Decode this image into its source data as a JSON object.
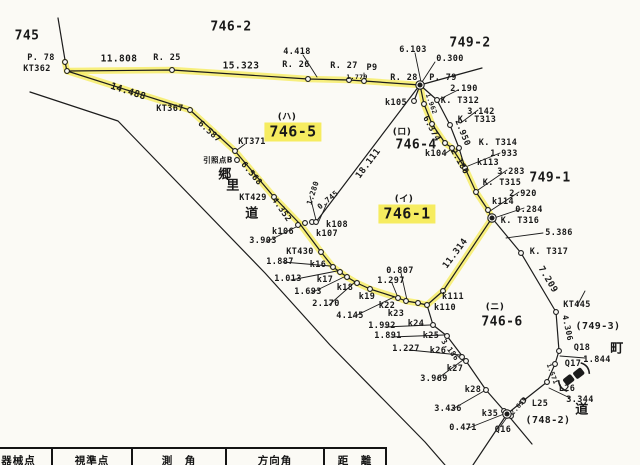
{
  "map": {
    "highlight_color": "#f6ec60",
    "ink_color": "#1c1c1c",
    "paper_color": "#fbfaf5",
    "highlighted_parcels": [
      "746-5",
      "746-1"
    ],
    "labels": [
      {
        "t": "745",
        "x": 27,
        "y": 36,
        "s": 13
      },
      {
        "t": "746-2",
        "x": 231,
        "y": 27,
        "s": 13
      },
      {
        "t": "P. 78",
        "x": 41,
        "y": 58
      },
      {
        "t": "KT362",
        "x": 37,
        "y": 69
      },
      {
        "t": "11.808",
        "x": 119,
        "y": 59,
        "s": 9.5
      },
      {
        "t": "R. 25",
        "x": 167,
        "y": 58
      },
      {
        "t": "15.323",
        "x": 241,
        "y": 66,
        "s": 9.5
      },
      {
        "t": "4.418",
        "x": 297,
        "y": 52
      },
      {
        "t": "R. 26",
        "x": 296,
        "y": 65
      },
      {
        "t": "R. 27",
        "x": 344,
        "y": 66
      },
      {
        "t": "P9",
        "x": 372,
        "y": 68
      },
      {
        "t": "1.779",
        "x": 357,
        "y": 77,
        "s": 6.5
      },
      {
        "t": "6.103",
        "x": 413,
        "y": 50
      },
      {
        "t": "749-2",
        "x": 470,
        "y": 43,
        "s": 13
      },
      {
        "t": "0.300",
        "x": 450,
        "y": 59
      },
      {
        "t": "R. 28",
        "x": 404,
        "y": 78
      },
      {
        "t": "P. 79",
        "x": 443,
        "y": 78
      },
      {
        "t": "2.190",
        "x": 464,
        "y": 89
      },
      {
        "t": "k105",
        "x": 396,
        "y": 103
      },
      {
        "t": "K. T312",
        "x": 460,
        "y": 101
      },
      {
        "t": "3.142",
        "x": 481,
        "y": 112
      },
      {
        "t": "K. T313",
        "x": 477,
        "y": 120
      },
      {
        "t": "1.962",
        "x": 431,
        "y": 104,
        "s": 6.5,
        "r": 70
      },
      {
        "t": "6.374",
        "x": 431,
        "y": 129,
        "r": 62
      },
      {
        "t": "2.950",
        "x": 462,
        "y": 133,
        "r": 68
      },
      {
        "t": "(ロ)",
        "x": 402,
        "y": 133,
        "s": 9,
        "cjk": true
      },
      {
        "t": "746-4",
        "x": 416,
        "y": 145,
        "s": 13
      },
      {
        "t": "k104",
        "x": 436,
        "y": 154
      },
      {
        "t": "K. T314",
        "x": 498,
        "y": 143
      },
      {
        "t": "1.933",
        "x": 504,
        "y": 154
      },
      {
        "t": "2.180",
        "x": 459,
        "y": 162,
        "r": 60
      },
      {
        "t": "k113",
        "x": 488,
        "y": 163
      },
      {
        "t": "3.283",
        "x": 511,
        "y": 172
      },
      {
        "t": "749-1",
        "x": 550,
        "y": 178,
        "s": 13
      },
      {
        "t": "K. T315",
        "x": 502,
        "y": 183
      },
      {
        "t": "2.920",
        "x": 523,
        "y": 194
      },
      {
        "t": "k114",
        "x": 503,
        "y": 202
      },
      {
        "t": "0.284",
        "x": 529,
        "y": 210
      },
      {
        "t": "K. T316",
        "x": 520,
        "y": 221
      },
      {
        "t": "5.386",
        "x": 559,
        "y": 233
      },
      {
        "t": "K. T317",
        "x": 549,
        "y": 252
      },
      {
        "t": "(ハ)",
        "x": 287,
        "y": 118,
        "s": 9,
        "cjk": true
      },
      {
        "t": "746-5",
        "x": 293,
        "y": 132,
        "s": 15,
        "hl": true
      },
      {
        "t": "KT367",
        "x": 170,
        "y": 109
      },
      {
        "t": "KT371",
        "x": 252,
        "y": 142
      },
      {
        "t": "引照点B",
        "x": 218,
        "y": 160,
        "s": 7.5,
        "cjk": true
      },
      {
        "t": "郷",
        "x": 225,
        "y": 175,
        "s": 13,
        "cjk": true
      },
      {
        "t": "里",
        "x": 233,
        "y": 186,
        "s": 13,
        "cjk": true
      },
      {
        "t": "道",
        "x": 252,
        "y": 214,
        "s": 13,
        "cjk": true
      },
      {
        "t": "KT429",
        "x": 253,
        "y": 198
      },
      {
        "t": "14.488",
        "x": 128,
        "y": 92,
        "s": 9.5,
        "r": 18
      },
      {
        "t": "6.587",
        "x": 209,
        "y": 132,
        "r": 42
      },
      {
        "t": "6.568",
        "x": 251,
        "y": 174,
        "r": 50
      },
      {
        "t": "4.352",
        "x": 281,
        "y": 210,
        "r": 55
      },
      {
        "t": "18.111",
        "x": 369,
        "y": 164,
        "s": 9,
        "r": -53
      },
      {
        "t": "(イ)",
        "x": 404,
        "y": 200,
        "s": 9,
        "cjk": true
      },
      {
        "t": "746-1",
        "x": 407,
        "y": 214,
        "s": 15,
        "hl": true
      },
      {
        "t": "1.280",
        "x": 313,
        "y": 193,
        "s": 7.5,
        "r": -72
      },
      {
        "t": "0.745",
        "x": 328,
        "y": 200,
        "s": 7.5,
        "r": -40
      },
      {
        "t": "k108",
        "x": 337,
        "y": 225
      },
      {
        "t": "k106",
        "x": 283,
        "y": 232
      },
      {
        "t": "k107",
        "x": 327,
        "y": 234
      },
      {
        "t": "3.903",
        "x": 263,
        "y": 241
      },
      {
        "t": "KT430",
        "x": 300,
        "y": 252
      },
      {
        "t": "1.887",
        "x": 280,
        "y": 262
      },
      {
        "t": "k16",
        "x": 318,
        "y": 265
      },
      {
        "t": "1.013",
        "x": 288,
        "y": 279
      },
      {
        "t": "k17",
        "x": 325,
        "y": 280
      },
      {
        "t": "1.693",
        "x": 308,
        "y": 292
      },
      {
        "t": "k18",
        "x": 345,
        "y": 288
      },
      {
        "t": "2.170",
        "x": 326,
        "y": 304
      },
      {
        "t": "k19",
        "x": 367,
        "y": 297
      },
      {
        "t": "4.145",
        "x": 350,
        "y": 316
      },
      {
        "t": "k22",
        "x": 387,
        "y": 306
      },
      {
        "t": "k23",
        "x": 396,
        "y": 314
      },
      {
        "t": "0.807",
        "x": 400,
        "y": 271
      },
      {
        "t": "1.297",
        "x": 391,
        "y": 281
      },
      {
        "t": "11.314",
        "x": 456,
        "y": 254,
        "s": 9,
        "r": -53
      },
      {
        "t": "k111",
        "x": 453,
        "y": 297
      },
      {
        "t": "k110",
        "x": 445,
        "y": 308
      },
      {
        "t": "(ニ)",
        "x": 495,
        "y": 308,
        "s": 9,
        "cjk": true
      },
      {
        "t": "746-6",
        "x": 502,
        "y": 322,
        "s": 13
      },
      {
        "t": "1.992",
        "x": 382,
        "y": 326
      },
      {
        "t": "k24",
        "x": 416,
        "y": 324
      },
      {
        "t": "1.891",
        "x": 388,
        "y": 336
      },
      {
        "t": "k25",
        "x": 431,
        "y": 336
      },
      {
        "t": "1.227",
        "x": 406,
        "y": 349
      },
      {
        "t": "k26",
        "x": 438,
        "y": 351
      },
      {
        "t": "3.186",
        "x": 450,
        "y": 350,
        "s": 7.5,
        "r": 54
      },
      {
        "t": "k27",
        "x": 455,
        "y": 369
      },
      {
        "t": "3.969",
        "x": 434,
        "y": 379
      },
      {
        "t": "k28",
        "x": 473,
        "y": 390
      },
      {
        "t": "3.436",
        "x": 448,
        "y": 409
      },
      {
        "t": "k35",
        "x": 490,
        "y": 414
      },
      {
        "t": "0.471",
        "x": 463,
        "y": 428
      },
      {
        "t": "Q16",
        "x": 503,
        "y": 430
      },
      {
        "t": "7.209",
        "x": 547,
        "y": 280,
        "s": 9,
        "r": 59
      },
      {
        "t": "KT445",
        "x": 577,
        "y": 305
      },
      {
        "t": "4.306",
        "x": 567,
        "y": 328,
        "s": 8,
        "r": 78
      },
      {
        "t": "(749-3)",
        "x": 598,
        "y": 327,
        "s": 10
      },
      {
        "t": "Q18",
        "x": 582,
        "y": 348
      },
      {
        "t": "町",
        "x": 617,
        "y": 349,
        "s": 13,
        "cjk": true
      },
      {
        "t": "1.844",
        "x": 597,
        "y": 360
      },
      {
        "t": "Q17",
        "x": 573,
        "y": 364
      },
      {
        "t": "1.571",
        "x": 552,
        "y": 374,
        "s": 6.5,
        "r": 70
      },
      {
        "t": "L26",
        "x": 567,
        "y": 389
      },
      {
        "t": "3.344",
        "x": 580,
        "y": 400
      },
      {
        "t": "道",
        "x": 582,
        "y": 410,
        "s": 13,
        "cjk": true
      },
      {
        "t": "L25",
        "x": 540,
        "y": 404
      },
      {
        "t": "2.659",
        "x": 519,
        "y": 406,
        "s": 6.5,
        "r": -48
      },
      {
        "t": "(748-2)",
        "x": 548,
        "y": 421,
        "s": 10
      }
    ]
  },
  "table": {
    "headers": [
      "器械点",
      "視準点",
      "測　角",
      "方向角",
      "距　離"
    ]
  }
}
